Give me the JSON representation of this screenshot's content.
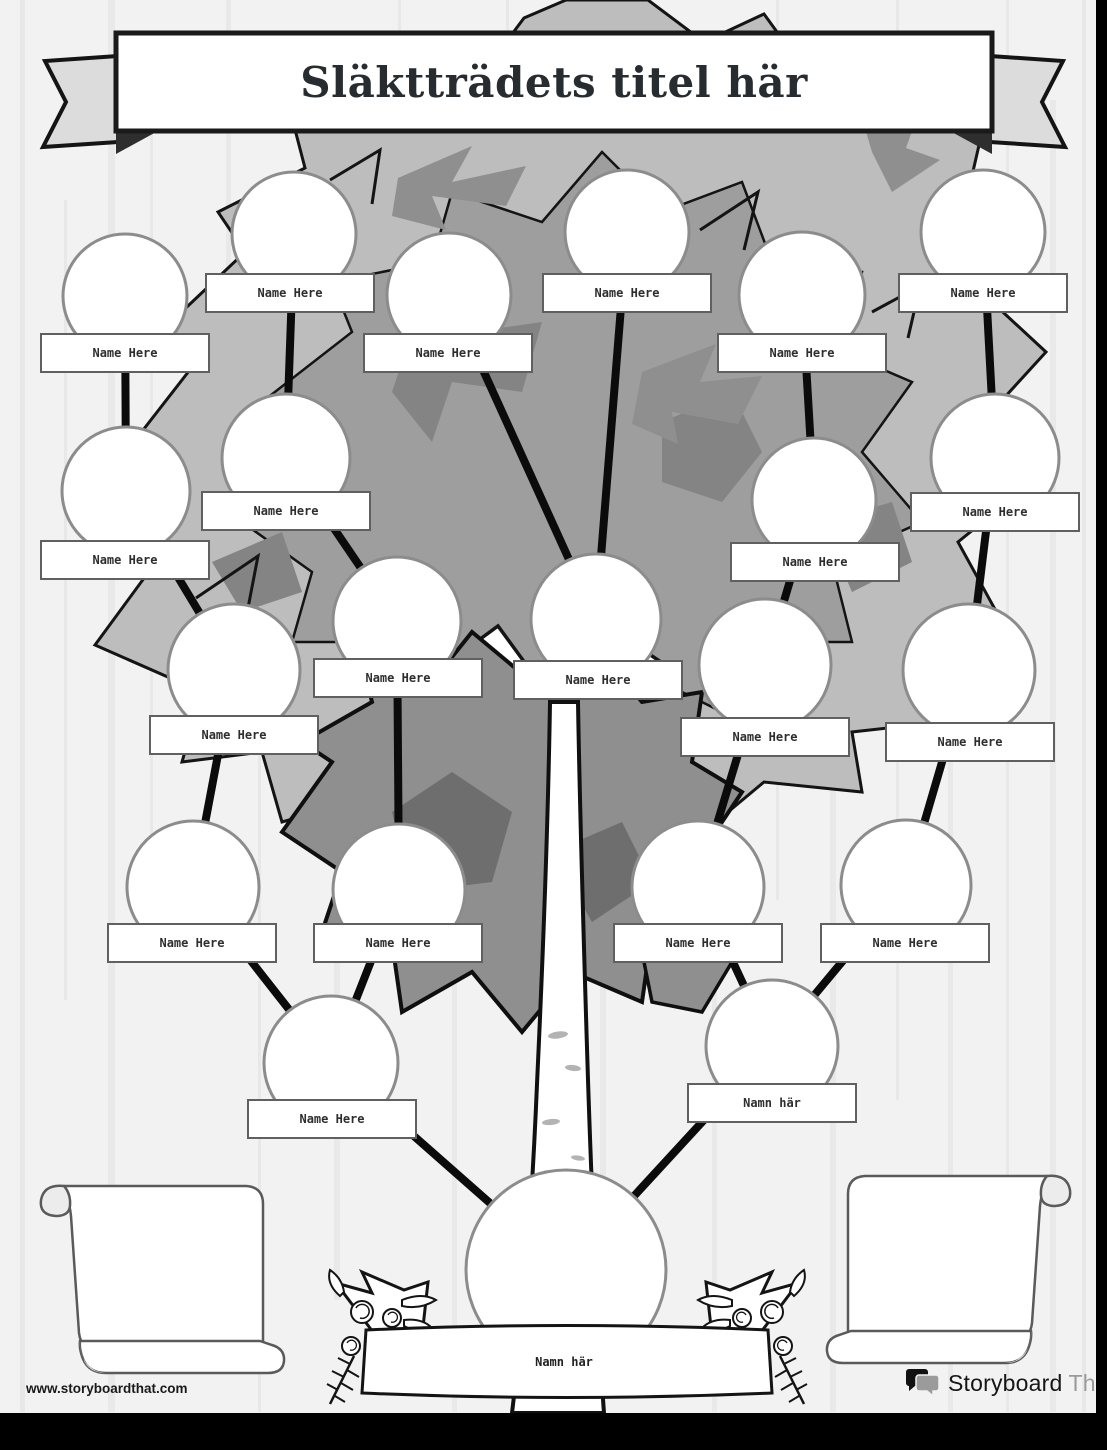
{
  "banner": {
    "title": "Släktträdets titel här"
  },
  "footer": {
    "url": "www.storyboardthat.com",
    "brand_black": "Storyboard",
    "brand_gray": "That"
  },
  "tree": {
    "root": {
      "id": "root",
      "x": 566,
      "y": 1270,
      "r": 100,
      "label": "Namn här",
      "label_x": 564,
      "label_y": 1362
    },
    "nodes": [
      {
        "id": "g1m1",
        "x": 125,
        "y": 296,
        "r": 62,
        "label": "Name Here",
        "label_x": 125,
        "label_y": 353
      },
      {
        "id": "g1m2",
        "x": 294,
        "y": 234,
        "r": 62,
        "label": "Name Here",
        "label_x": 290,
        "label_y": 293
      },
      {
        "id": "g1m3",
        "x": 449,
        "y": 295,
        "r": 62,
        "label": "Name Here",
        "label_x": 448,
        "label_y": 353
      },
      {
        "id": "g1m4",
        "x": 627,
        "y": 232,
        "r": 62,
        "label": "Name Here",
        "label_x": 627,
        "label_y": 293
      },
      {
        "id": "g1m5",
        "x": 802,
        "y": 295,
        "r": 63,
        "label": "Name Here",
        "label_x": 802,
        "label_y": 353
      },
      {
        "id": "g1m6",
        "x": 983,
        "y": 232,
        "r": 62,
        "label": "Name Here",
        "label_x": 983,
        "label_y": 293
      },
      {
        "id": "g2m1",
        "x": 126,
        "y": 491,
        "r": 64,
        "label": "Name Here",
        "label_x": 125,
        "label_y": 560
      },
      {
        "id": "g2m2",
        "x": 286,
        "y": 458,
        "r": 64,
        "label": "Name Here",
        "label_x": 286,
        "label_y": 511
      },
      {
        "id": "g2m3",
        "x": 814,
        "y": 500,
        "r": 62,
        "label": "Name Here",
        "label_x": 815,
        "label_y": 562
      },
      {
        "id": "g2m4",
        "x": 995,
        "y": 458,
        "r": 64,
        "label": "Name Here",
        "label_x": 995,
        "label_y": 512
      },
      {
        "id": "g3m1",
        "x": 234,
        "y": 670,
        "r": 66,
        "label": "Name Here",
        "label_x": 234,
        "label_y": 735
      },
      {
        "id": "g3m2",
        "x": 397,
        "y": 621,
        "r": 64,
        "label": "Name Here",
        "label_x": 398,
        "label_y": 678
      },
      {
        "id": "g3m3",
        "x": 596,
        "y": 619,
        "r": 65,
        "label": "Name Here",
        "label_x": 598,
        "label_y": 680
      },
      {
        "id": "g3m4",
        "x": 765,
        "y": 665,
        "r": 66,
        "label": "Name Here",
        "label_x": 765,
        "label_y": 737
      },
      {
        "id": "g3m5",
        "x": 969,
        "y": 670,
        "r": 66,
        "label": "Name Here",
        "label_x": 970,
        "label_y": 742
      },
      {
        "id": "g4m1",
        "x": 193,
        "y": 887,
        "r": 66,
        "label": "Name Here",
        "label_x": 192,
        "label_y": 943
      },
      {
        "id": "g4m2",
        "x": 399,
        "y": 890,
        "r": 66,
        "label": "Name Here",
        "label_x": 398,
        "label_y": 943
      },
      {
        "id": "g4m3",
        "x": 698,
        "y": 887,
        "r": 66,
        "label": "Name Here",
        "label_x": 698,
        "label_y": 943
      },
      {
        "id": "g4m4",
        "x": 906,
        "y": 885,
        "r": 65,
        "label": "Name Here",
        "label_x": 905,
        "label_y": 943
      },
      {
        "id": "g5m1",
        "x": 331,
        "y": 1063,
        "r": 67,
        "label": "Name Here",
        "label_x": 332,
        "label_y": 1119
      },
      {
        "id": "g5m2",
        "x": 772,
        "y": 1046,
        "r": 66,
        "label": "Namn här",
        "label_x": 772,
        "label_y": 1103
      }
    ],
    "connections": [
      [
        "root",
        "g5m1"
      ],
      [
        "root",
        "g5m2"
      ],
      [
        "g5m1",
        "g4m1"
      ],
      [
        "g5m1",
        "g4m2"
      ],
      [
        "g5m2",
        "g4m3"
      ],
      [
        "g5m2",
        "g4m4"
      ],
      [
        "g4m1",
        "g3m1"
      ],
      [
        "g4m2",
        "g3m2"
      ],
      [
        "g4m3",
        "g3m4"
      ],
      [
        "g4m4",
        "g3m5"
      ],
      [
        "g3m1",
        "g2m1"
      ],
      [
        "g3m2",
        "g2m2"
      ],
      [
        "g3m4",
        "g2m3"
      ],
      [
        "g3m5",
        "g2m4"
      ],
      [
        "g3m3",
        "g1m3"
      ],
      [
        "g3m3",
        "g1m4"
      ],
      [
        "g2m1",
        "g1m1"
      ],
      [
        "g2m2",
        "g1m2"
      ],
      [
        "g2m3",
        "g1m5"
      ],
      [
        "g2m4",
        "g1m6"
      ]
    ]
  },
  "colors": {
    "paper": "#f2f2f2",
    "foliage_light": "#bdbdbd",
    "foliage_mid": "#9e9e9e",
    "foliage_dark": "#848484",
    "ink": "#141414",
    "circle_stroke": "#8c8c8c",
    "label_border": "#606060",
    "brand_gray": "#9b9b9b"
  }
}
